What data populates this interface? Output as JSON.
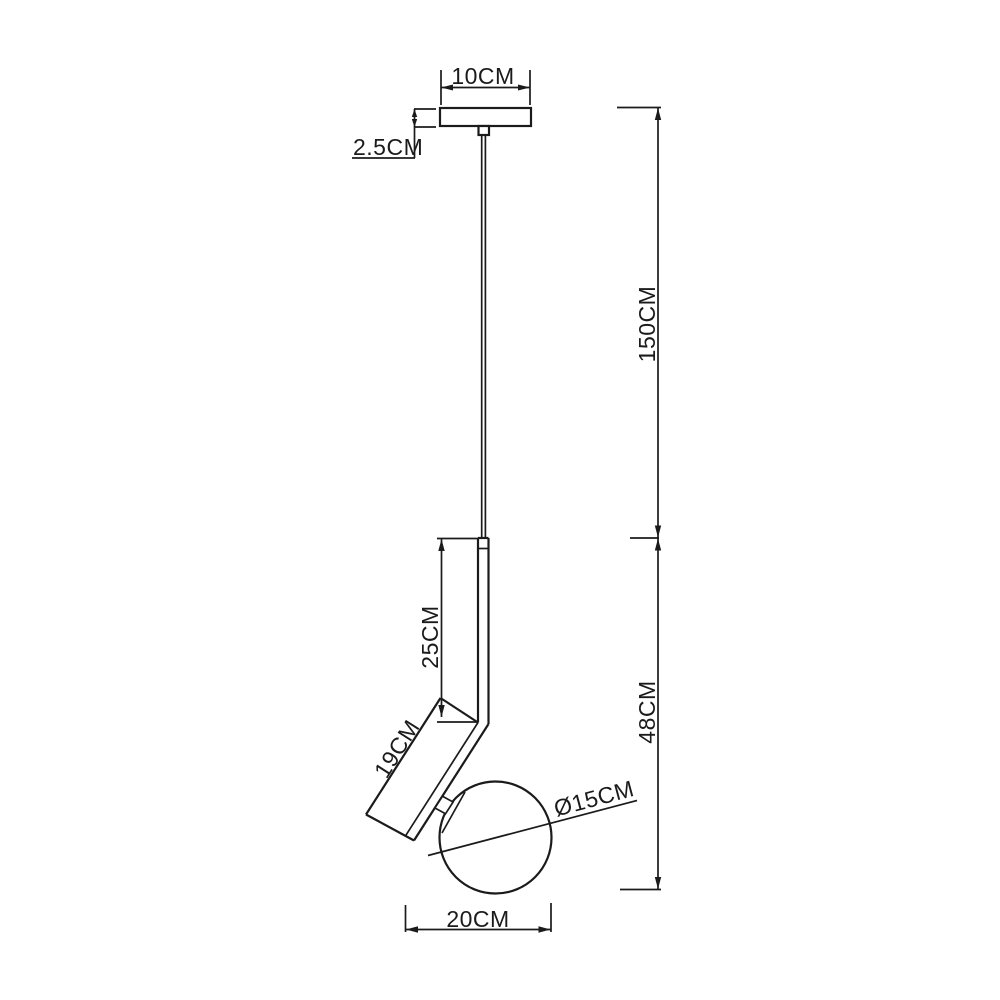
{
  "page": {
    "background": "#ffffff",
    "line_color": "#1b1b1b"
  },
  "diagram": {
    "subject": "pendant lamp dimension drawing",
    "labels": {
      "canopy_width": "10CM",
      "canopy_thickness": "2.5CM",
      "suspension_height": "150CM",
      "body_height": "48CM",
      "upper_tube_length": "25CM",
      "angled_tube_length": "19CM",
      "globe_diameter": "Ø15CM",
      "body_width": "20CM"
    }
  }
}
